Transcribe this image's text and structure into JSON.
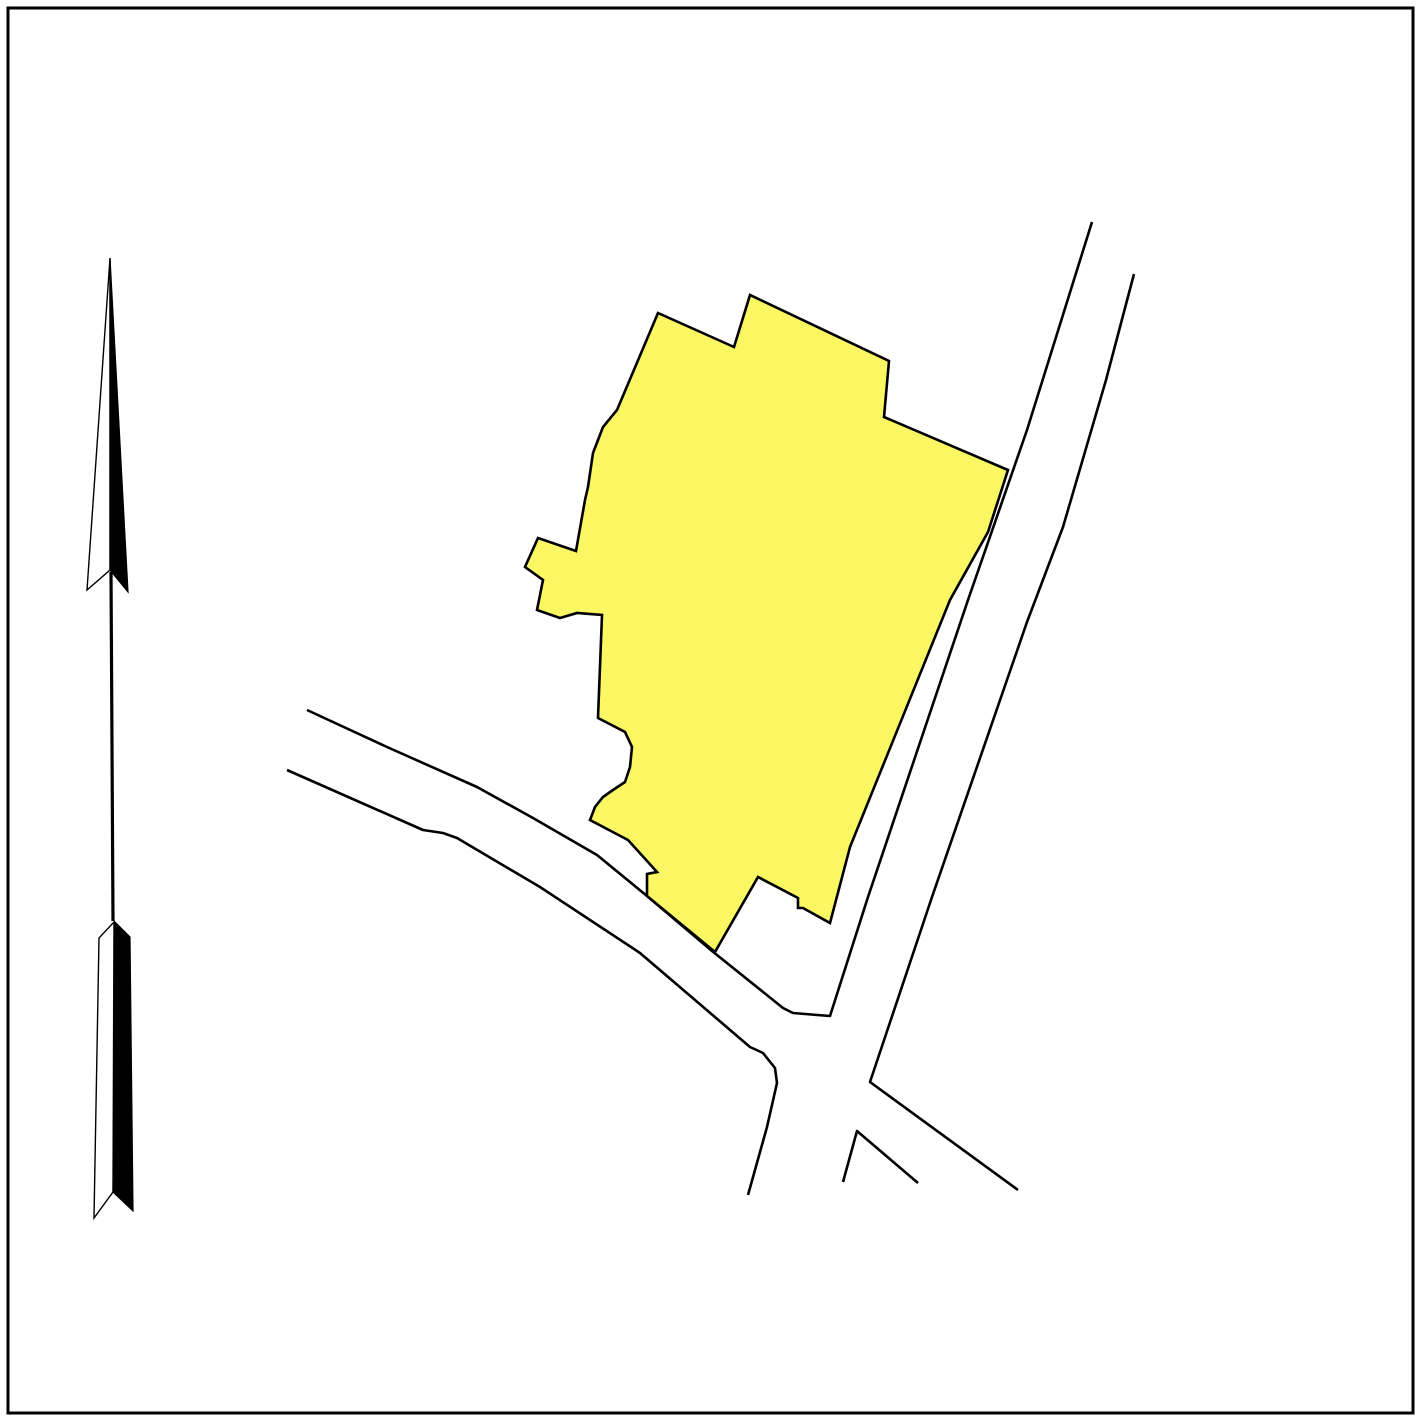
{
  "canvas": {
    "width": 1421,
    "height": 1421,
    "background_color": "#ffffff",
    "border_color": "#000000",
    "border_inset": 8,
    "border_stroke_width": 3
  },
  "map": {
    "parcel": {
      "label": "highlighted-parcel",
      "fill_color": "#fbf763",
      "outline_color": "#000000",
      "points": [
        [
          658,
          313
        ],
        [
          734,
          347
        ],
        [
          750,
          295
        ],
        [
          889,
          361
        ],
        [
          884,
          417
        ],
        [
          1008,
          470
        ],
        [
          988,
          532
        ],
        [
          950,
          600
        ],
        [
          850,
          847
        ],
        [
          830,
          923
        ],
        [
          803,
          908
        ],
        [
          798,
          908
        ],
        [
          798,
          898
        ],
        [
          758,
          877
        ],
        [
          715,
          952
        ],
        [
          647,
          896
        ],
        [
          647,
          874
        ],
        [
          657,
          872
        ],
        [
          628,
          840
        ],
        [
          590,
          820
        ],
        [
          595,
          807
        ],
        [
          603,
          797
        ],
        [
          613,
          790
        ],
        [
          625,
          782
        ],
        [
          630,
          767
        ],
        [
          632,
          747
        ],
        [
          625,
          732
        ],
        [
          598,
          718
        ],
        [
          602,
          615
        ],
        [
          577,
          613
        ],
        [
          560,
          618
        ],
        [
          537,
          610
        ],
        [
          543,
          580
        ],
        [
          525,
          567
        ],
        [
          538,
          538
        ],
        [
          576,
          551
        ],
        [
          585,
          500
        ],
        [
          588,
          487
        ],
        [
          593,
          453
        ],
        [
          603,
          427
        ],
        [
          617,
          410
        ]
      ]
    },
    "roads": [
      {
        "label": "northwest-road-upper-edge-into-northeast-road-left-edge",
        "points": [
          [
            307,
            710
          ],
          [
            387,
            747
          ],
          [
            477,
            787
          ],
          [
            533,
            818
          ],
          [
            597,
            855
          ],
          [
            647,
            896
          ],
          [
            712,
            951
          ],
          [
            783,
            1008
          ],
          [
            793,
            1013
          ],
          [
            830,
            1016
          ],
          [
            868,
            897
          ],
          [
            968,
            600
          ],
          [
            1027,
            430
          ],
          [
            1092,
            222
          ]
        ]
      },
      {
        "label": "northeast-road-right-edge",
        "points": [
          [
            1134,
            274
          ],
          [
            1106,
            380
          ],
          [
            1063,
            527
          ],
          [
            1027,
            622
          ],
          [
            932,
            897
          ],
          [
            870,
            1082
          ],
          [
            1018,
            1190
          ]
        ]
      },
      {
        "label": "northwest-road-lower-edge-curving-south",
        "points": [
          [
            287,
            770
          ],
          [
            423,
            830
          ],
          [
            443,
            833
          ],
          [
            457,
            838
          ],
          [
            540,
            887
          ],
          [
            640,
            953
          ],
          [
            750,
            1047
          ],
          [
            763,
            1053
          ],
          [
            775,
            1068
          ],
          [
            777,
            1083
          ],
          [
            767,
            1127
          ],
          [
            748,
            1195
          ]
        ]
      },
      {
        "label": "south-road-fork-wedge",
        "points": [
          [
            843,
            1182
          ],
          [
            857,
            1131
          ],
          [
            918,
            1183
          ]
        ]
      }
    ],
    "road_color": "#000000"
  },
  "north_arrow": {
    "head_white_half": [
      [
        110,
        258
      ],
      [
        87,
        590
      ],
      [
        110,
        570
      ]
    ],
    "head_black_half": [
      [
        110,
        258
      ],
      [
        110,
        570
      ],
      [
        128,
        592
      ]
    ],
    "shaft": [
      [
        111,
        572
      ],
      [
        113,
        921
      ]
    ],
    "tail_white_half": [
      [
        114,
        922
      ],
      [
        99,
        938
      ],
      [
        94,
        1218
      ],
      [
        113,
        1192
      ]
    ],
    "tail_black_half": [
      [
        115,
        922
      ],
      [
        130,
        937
      ],
      [
        133,
        1211
      ],
      [
        113,
        1192
      ]
    ],
    "white_fill": "#ffffff",
    "black_fill": "#000000",
    "outline_color": "#000000"
  }
}
